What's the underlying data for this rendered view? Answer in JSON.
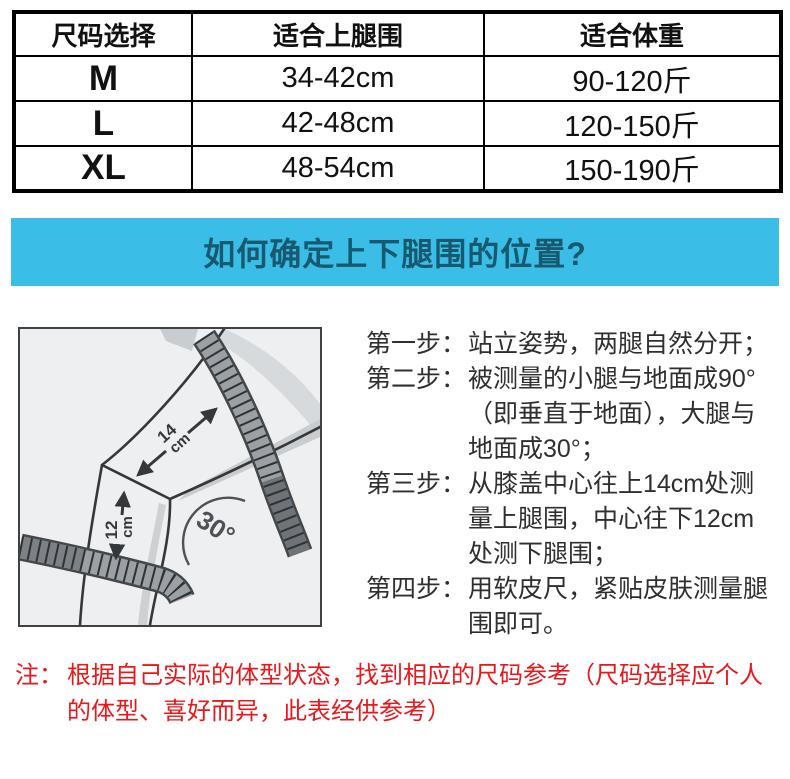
{
  "size_table": {
    "headers": [
      "尺码选择",
      "适合上腿围",
      "适合体重"
    ],
    "rows": [
      [
        "M",
        "34-42cm",
        "90-120斤"
      ],
      [
        "L",
        "42-48cm",
        "120-150斤"
      ],
      [
        "XL",
        "48-54cm",
        "150-190斤"
      ]
    ]
  },
  "banner": {
    "title": "如何确定上下腿围的位置?"
  },
  "diagram": {
    "upper_value": "14",
    "upper_unit": "cm",
    "lower_value": "12",
    "lower_unit": "cm",
    "angle": "30°"
  },
  "steps": [
    {
      "label": "第一步：",
      "text": "站立姿势，两腿自然分开；"
    },
    {
      "label": "第二步：",
      "text": "被测量的小腿与地面成90°（即垂直于地面），大腿与地面成30°；"
    },
    {
      "label": "第三步：",
      "text": "从膝盖中心往上14cm处测量上腿围，中心往下12cm处测下腿围；"
    },
    {
      "label": "第四步：",
      "text": "用软皮尺，紧贴皮肤测量腿围即可。"
    }
  ],
  "note": {
    "label": "注：",
    "text": "根据自己实际的体型状态，找到相应的尺码参考（尺码选择应个人的体型、喜好而异，此表经供参考）"
  },
  "colors": {
    "banner_bg": "#3abde6",
    "banner_text": "#175a70",
    "note_red": "#e9181b",
    "table_border": "#000000",
    "diagram_bg": "#edeff0",
    "step_text": "#2f2f2f"
  }
}
